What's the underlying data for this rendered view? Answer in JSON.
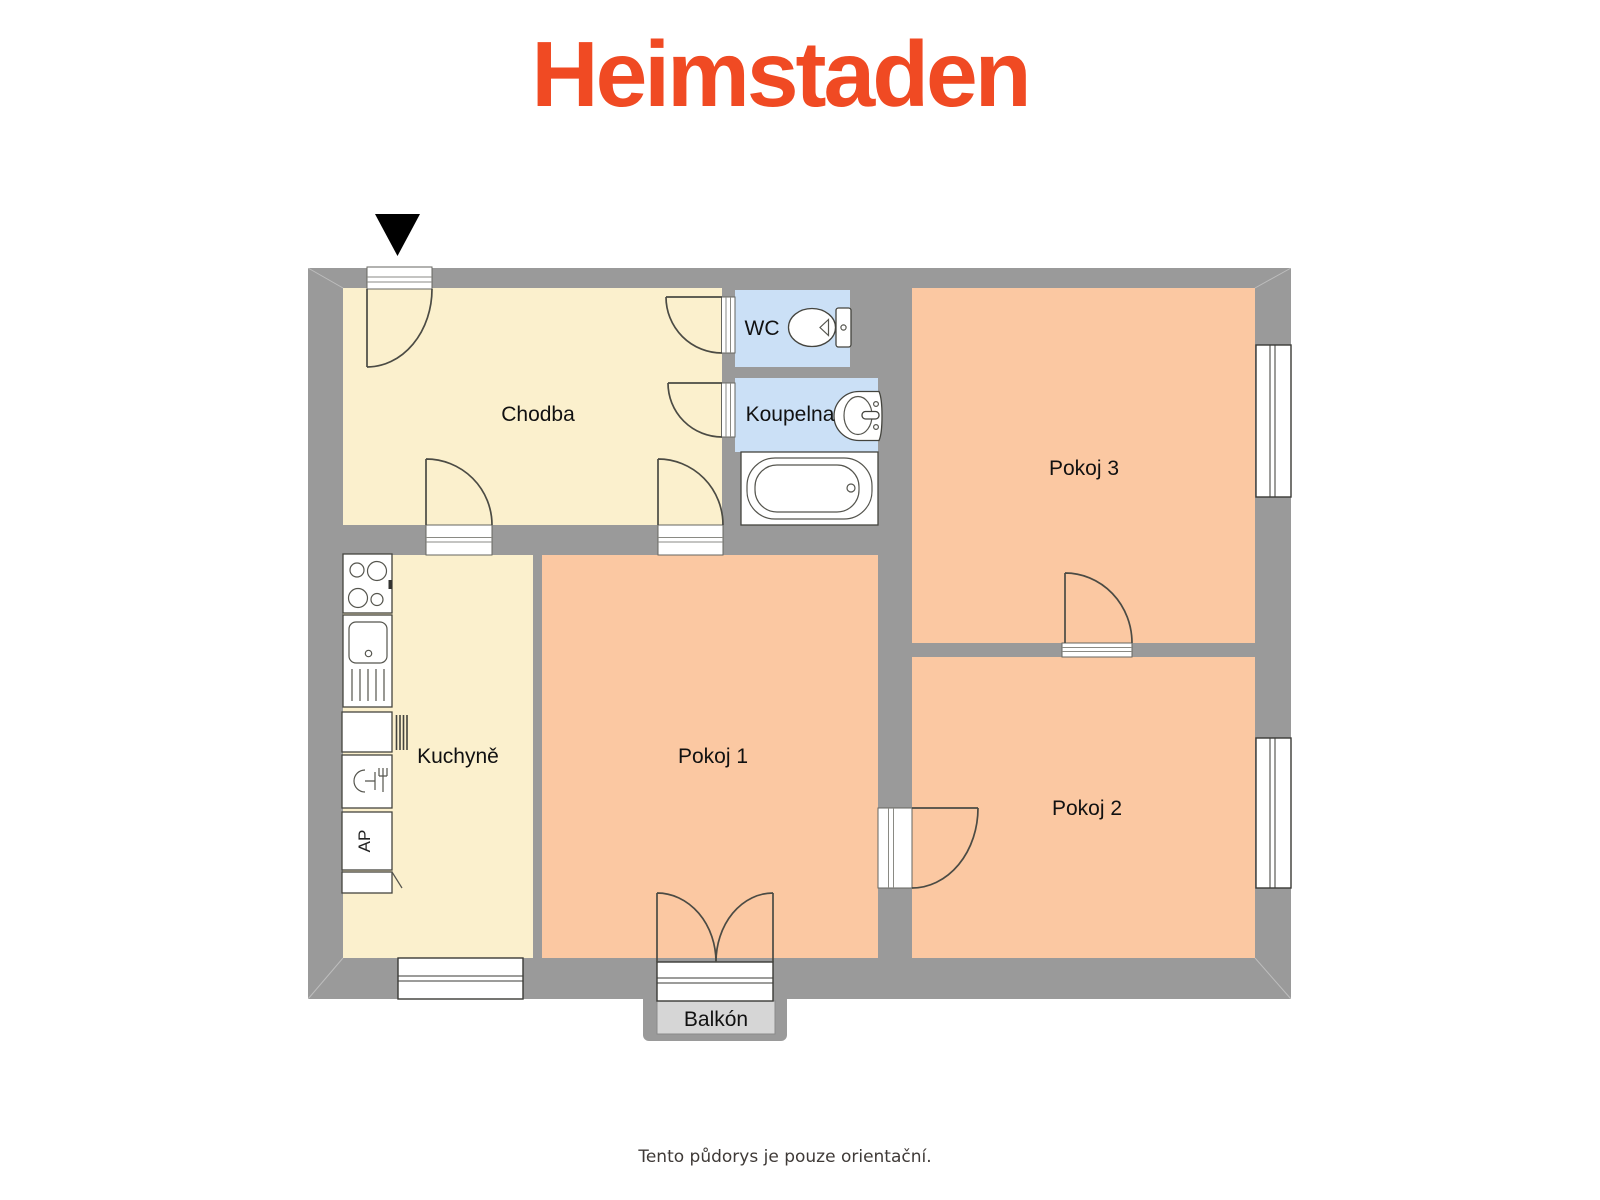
{
  "brand": {
    "logo_text": "Heimstaden",
    "logo_color": "#F04A23"
  },
  "floor_plan": {
    "wall_color": "#9A9A9A",
    "entrance_marker": {
      "icon": "down-triangle-icon",
      "color": "#000000"
    },
    "rooms": {
      "chodba": {
        "label": "Chodba",
        "fill": "#FBF0CD",
        "type": "hallway"
      },
      "wc": {
        "label": "WC",
        "fill": "#CBE0F6",
        "type": "toilet"
      },
      "koupelna": {
        "label": "Koupelna",
        "fill": "#CBE0F6",
        "type": "bathroom"
      },
      "kuchyne": {
        "label": "Kuchyně",
        "fill": "#FBF0CD",
        "type": "kitchen"
      },
      "pokoj1": {
        "label": "Pokoj 1",
        "fill": "#FBC8A2",
        "type": "room"
      },
      "pokoj2": {
        "label": "Pokoj 2",
        "fill": "#FBC8A2",
        "type": "room"
      },
      "pokoj3": {
        "label": "Pokoj 3",
        "fill": "#FBC8A2",
        "type": "room"
      },
      "balkon": {
        "label": "Balkón",
        "fill": "#D6D6D6",
        "type": "balcony"
      }
    },
    "fixtures": {
      "washing_machine_label": "AP",
      "icons": [
        "toilet-icon",
        "washbasin-icon",
        "bathtub-icon",
        "stove-icon",
        "kitchen-sink-icon",
        "dishwasher-icon",
        "washing-machine-icon",
        "kitchen-cabinet-icon",
        "radiator-icon"
      ]
    }
  },
  "footer": {
    "disclaimer": "Tento půdorys je pouze orientační."
  }
}
